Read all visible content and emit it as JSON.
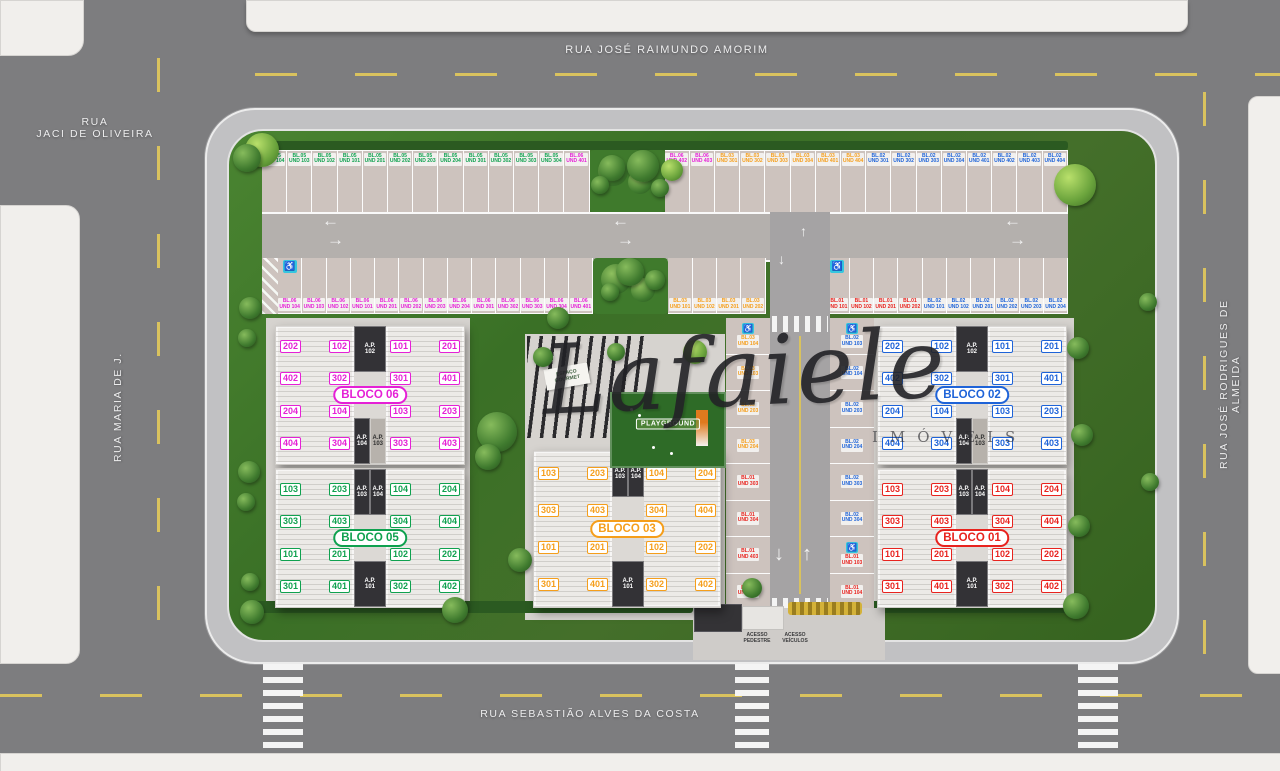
{
  "streets": {
    "top": "RUA JOSÉ RAIMUNDO AMORIM",
    "left_corner": "RUA\nJACI DE OLIVEIRA",
    "left": "RUA MARIA DE J.",
    "right": "RUA JOSÉ RODRIGUES DE ALMEIDA",
    "bottom": "RUA SEBASTIÃO ALVES DA COSTA"
  },
  "brand": {
    "name": "Lafaiele",
    "subtitle": "IMÓVEIS"
  },
  "amenities": {
    "gourmet": "ESPAÇO\nGOURMET",
    "playground": "PLAYGROUND"
  },
  "access": {
    "pedestrian": "ACESSO\nPEDESTRE",
    "vehicles": "ACESSO\nVEÍCULOS"
  },
  "icons": {
    "wheelchair": "♿",
    "arrow_left": "←",
    "arrow_right": "→",
    "arrow_up": "↑",
    "arrow_down": "↓"
  },
  "colors": {
    "b01": "#e8231e",
    "b02": "#1e63d8",
    "b03": "#f59e1b",
    "b05": "#0fa14f",
    "b06": "#e520d6"
  },
  "blocos": [
    {
      "key": "b06",
      "label": "BLOCO 06",
      "type": "A",
      "wing_left": [
        [
          "202",
          "102"
        ],
        [
          "402",
          "302"
        ],
        [
          "204",
          "104"
        ],
        [
          "404",
          "304"
        ]
      ],
      "wing_right": [
        [
          "101",
          "201"
        ],
        [
          "301",
          "401"
        ],
        [
          "103",
          "203"
        ],
        [
          "303",
          "403"
        ]
      ],
      "cores_top": [
        {
          "l1": "A.P.",
          "l2": "102",
          "dark": true
        }
      ],
      "cores_bottom": [
        {
          "l1": "A.P.",
          "l2": "104",
          "dark": true
        },
        {
          "l1": "A.P.",
          "l2": "103",
          "dark": false
        }
      ]
    },
    {
      "key": "b05",
      "label": "BLOCO 05",
      "type": "B",
      "wing_left": [
        [
          "103",
          "203"
        ],
        [
          "303",
          "403"
        ],
        [
          "101",
          "201"
        ],
        [
          "301",
          "401"
        ]
      ],
      "wing_right": [
        [
          "104",
          "204"
        ],
        [
          "304",
          "404"
        ],
        [
          "102",
          "202"
        ],
        [
          "302",
          "402"
        ]
      ],
      "cores_top": [
        {
          "l1": "A.P.",
          "l2": "103",
          "dark": true
        },
        {
          "l1": "A.P.",
          "l2": "104",
          "dark": true
        }
      ],
      "cores_bottom": [
        {
          "l1": "A.P.",
          "l2": "101",
          "dark": true
        }
      ]
    },
    {
      "key": "b03",
      "label": "BLOCO 03",
      "type": "B",
      "wing_left": [
        [
          "103",
          "203"
        ],
        [
          "303",
          "403"
        ],
        [
          "101",
          "201"
        ],
        [
          "301",
          "401"
        ]
      ],
      "wing_right": [
        [
          "104",
          "204"
        ],
        [
          "304",
          "404"
        ],
        [
          "102",
          "202"
        ],
        [
          "302",
          "402"
        ]
      ],
      "cores_top": [
        {
          "l1": "A.P.",
          "l2": "103",
          "dark": true
        },
        {
          "l1": "A.P.",
          "l2": "104",
          "dark": true
        }
      ],
      "cores_bottom": [
        {
          "l1": "A.P.",
          "l2": "101",
          "dark": true
        }
      ]
    },
    {
      "key": "b02",
      "label": "BLOCO 02",
      "type": "A",
      "wing_left": [
        [
          "202",
          "102"
        ],
        [
          "402",
          "302"
        ],
        [
          "204",
          "104"
        ],
        [
          "404",
          "304"
        ]
      ],
      "wing_right": [
        [
          "101",
          "201"
        ],
        [
          "301",
          "401"
        ],
        [
          "103",
          "203"
        ],
        [
          "303",
          "403"
        ]
      ],
      "cores_top": [
        {
          "l1": "A.P.",
          "l2": "102",
          "dark": true
        }
      ],
      "cores_bottom": [
        {
          "l1": "A.P.",
          "l2": "104",
          "dark": true
        },
        {
          "l1": "A.P.",
          "l2": "103",
          "dark": false
        }
      ]
    },
    {
      "key": "b01",
      "label": "BLOCO 01",
      "type": "B",
      "wing_left": [
        [
          "103",
          "203"
        ],
        [
          "303",
          "403"
        ],
        [
          "101",
          "201"
        ],
        [
          "301",
          "401"
        ]
      ],
      "wing_right": [
        [
          "104",
          "204"
        ],
        [
          "304",
          "404"
        ],
        [
          "102",
          "202"
        ],
        [
          "302",
          "402"
        ]
      ],
      "cores_top": [
        {
          "l1": "A.P.",
          "l2": "103",
          "dark": true
        },
        {
          "l1": "A.P.",
          "l2": "104",
          "dark": true
        }
      ],
      "cores_bottom": [
        {
          "l1": "A.P.",
          "l2": "101",
          "dark": true
        }
      ]
    }
  ],
  "parking": {
    "row1": [
      {
        "b": "BL.05",
        "u": "UND 104",
        "k": "b05"
      },
      {
        "b": "BL.05",
        "u": "UND 103",
        "k": "b05"
      },
      {
        "b": "BL.05",
        "u": "UND 102",
        "k": "b05"
      },
      {
        "b": "BL.05",
        "u": "UND 101",
        "k": "b05"
      },
      {
        "b": "BL.05",
        "u": "UND 201",
        "k": "b05"
      },
      {
        "b": "BL.05",
        "u": "UND 202",
        "k": "b05"
      },
      {
        "b": "BL.05",
        "u": "UND 203",
        "k": "b05"
      },
      {
        "b": "BL.05",
        "u": "UND 204",
        "k": "b05"
      },
      {
        "b": "BL.05",
        "u": "UND 301",
        "k": "b05"
      },
      {
        "b": "BL.05",
        "u": "UND 302",
        "k": "b05"
      },
      {
        "b": "BL.05",
        "u": "UND 303",
        "k": "b05"
      },
      {
        "b": "BL.05",
        "u": "UND 304",
        "k": "b05"
      },
      {
        "b": "BL.06",
        "u": "UND 401",
        "k": "b06"
      },
      {
        "island": true
      },
      {
        "b": "BL.06",
        "u": "UND 402",
        "k": "b06"
      },
      {
        "b": "BL.06",
        "u": "UND 403",
        "k": "b06"
      },
      {
        "b": "BL.03",
        "u": "UND 301",
        "k": "b03"
      },
      {
        "b": "BL.03",
        "u": "UND 302",
        "k": "b03"
      },
      {
        "b": "BL.03",
        "u": "UND 303",
        "k": "b03"
      },
      {
        "b": "BL.03",
        "u": "UND 304",
        "k": "b03"
      },
      {
        "b": "BL.03",
        "u": "UND 401",
        "k": "b03"
      },
      {
        "b": "BL.03",
        "u": "UND 404",
        "k": "b03"
      },
      {
        "b": "BL.02",
        "u": "UND 301",
        "k": "b02"
      },
      {
        "b": "BL.02",
        "u": "UND 302",
        "k": "b02"
      },
      {
        "b": "BL.02",
        "u": "UND 303",
        "k": "b02"
      },
      {
        "b": "BL.02",
        "u": "UND 304",
        "k": "b02"
      },
      {
        "b": "BL.02",
        "u": "UND 401",
        "k": "b02"
      },
      {
        "b": "BL.02",
        "u": "UND 402",
        "k": "b02"
      },
      {
        "b": "BL.02",
        "u": "UND 403",
        "k": "b02"
      },
      {
        "b": "BL.02",
        "u": "UND 404",
        "k": "b02"
      }
    ],
    "row2": [
      {
        "hatch": true
      },
      {
        "b": "BL.06",
        "u": "UND 104",
        "k": "b06",
        "wc": true
      },
      {
        "b": "BL.06",
        "u": "UND 103",
        "k": "b06"
      },
      {
        "b": "BL.06",
        "u": "UND 102",
        "k": "b06"
      },
      {
        "b": "BL.06",
        "u": "UND 101",
        "k": "b06"
      },
      {
        "b": "BL.06",
        "u": "UND 201",
        "k": "b06"
      },
      {
        "b": "BL.06",
        "u": "UND 202",
        "k": "b06"
      },
      {
        "b": "BL.06",
        "u": "UND 203",
        "k": "b06"
      },
      {
        "b": "BL.06",
        "u": "UND 204",
        "k": "b06"
      },
      {
        "b": "BL.06",
        "u": "UND 301",
        "k": "b06"
      },
      {
        "b": "BL.06",
        "u": "UND 302",
        "k": "b06"
      },
      {
        "b": "BL.06",
        "u": "UND 303",
        "k": "b06"
      },
      {
        "b": "BL.06",
        "u": "UND 304",
        "k": "b06"
      },
      {
        "b": "BL.06",
        "u": "UND 401",
        "k": "b06"
      },
      {
        "island": true
      },
      {
        "b": "BL.03",
        "u": "UND 101",
        "k": "b03"
      },
      {
        "b": "BL.03",
        "u": "UND 102",
        "k": "b03"
      },
      {
        "b": "BL.03",
        "u": "UND 201",
        "k": "b03"
      },
      {
        "b": "BL.03",
        "u": "UND 202",
        "k": "b03"
      },
      {
        "gap": true
      },
      {
        "b": "BL.01",
        "u": "UND 101",
        "k": "b01",
        "wc": true
      },
      {
        "b": "BL.01",
        "u": "UND 102",
        "k": "b01"
      },
      {
        "b": "BL.01",
        "u": "UND 201",
        "k": "b01"
      },
      {
        "b": "BL.01",
        "u": "UND 202",
        "k": "b01"
      },
      {
        "b": "BL.02",
        "u": "UND 101",
        "k": "b02"
      },
      {
        "b": "BL.02",
        "u": "UND 102",
        "k": "b02"
      },
      {
        "b": "BL.02",
        "u": "UND 201",
        "k": "b02"
      },
      {
        "b": "BL.02",
        "u": "UND 202",
        "k": "b02"
      },
      {
        "b": "BL.02",
        "u": "UND 203",
        "k": "b02"
      },
      {
        "b": "BL.02",
        "u": "UND 204",
        "k": "b02"
      }
    ],
    "col_left": [
      {
        "b": "BL.03",
        "u": "UND 104",
        "k": "b03",
        "wc": true
      },
      {
        "b": "BL.03",
        "u": "UND 103",
        "k": "b03"
      },
      {
        "b": "BL.03",
        "u": "UND 203",
        "k": "b03"
      },
      {
        "b": "BL.03",
        "u": "UND 204",
        "k": "b03"
      },
      {
        "b": "BL.01",
        "u": "UND 303",
        "k": "b01"
      },
      {
        "b": "BL.01",
        "u": "UND 304",
        "k": "b01"
      },
      {
        "b": "BL.01",
        "u": "UND 403",
        "k": "b01"
      },
      {
        "b": "BL.01",
        "u": "UND 404",
        "k": "b01"
      }
    ],
    "col_right": [
      {
        "b": "BL.02",
        "u": "UND 103",
        "k": "b02",
        "wc": true
      },
      {
        "b": "BL.02",
        "u": "UND 104",
        "k": "b02"
      },
      {
        "b": "BL.02",
        "u": "UND 203",
        "k": "b02"
      },
      {
        "b": "BL.02",
        "u": "UND 204",
        "k": "b02"
      },
      {
        "b": "BL.02",
        "u": "UND 303",
        "k": "b02"
      },
      {
        "b": "BL.02",
        "u": "UND 304",
        "k": "b02"
      },
      {
        "b": "BL.01",
        "u": "UND 103",
        "k": "b01",
        "wc": true
      },
      {
        "b": "BL.01",
        "u": "UND 104",
        "k": "b01"
      }
    ]
  }
}
